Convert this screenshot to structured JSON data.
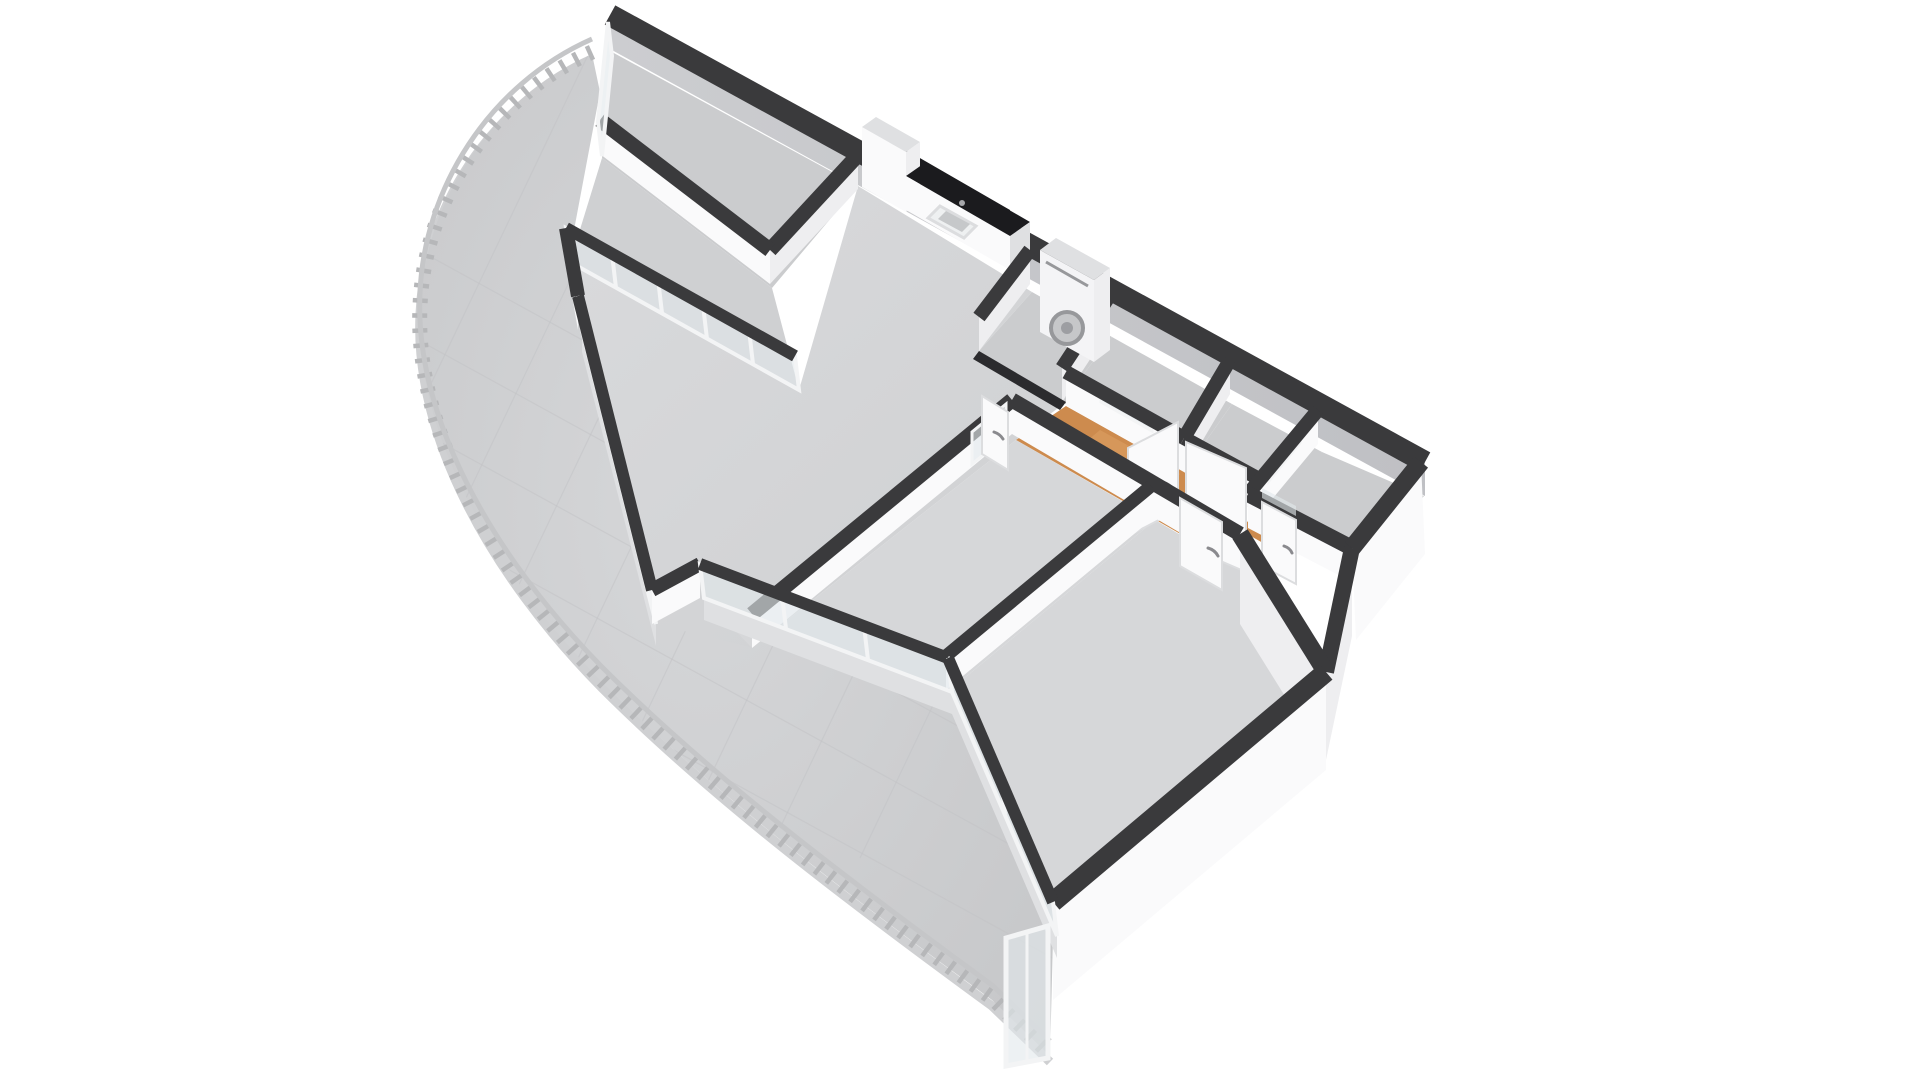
{
  "scene": {
    "kind": "3d-floorplan-axonometric-render",
    "background": "#ffffff",
    "colors": {
      "wall_cap": "#3a3a3c",
      "face_white": "#fafafb",
      "face_light": "#eeeef0",
      "face_gray": "#c7c8cb",
      "face_shade": "#dfe0e2",
      "floor_main": "#d6d7d9",
      "floor_dark": "#cbccce",
      "floor_balcony": "#cfd0d2",
      "wood": "#cd8b4e",
      "wood_light": "#dfa264",
      "counter": "#1b1b1e",
      "trim": "#2b2b2e",
      "railing_post": "#b6b7b9",
      "railing_rail": "#c5c6c8",
      "slab": "#cfd0d2",
      "glass": "#e2e8ec",
      "frame": "#f3f4f5",
      "appliance": "#f4f4f6",
      "appliance_detail": "#97989b"
    },
    "rooms": [
      {
        "id": "balcony",
        "floor": "gray-tile",
        "feature": "curved-edge-with-railing"
      },
      {
        "id": "top-room",
        "floor": "gray"
      },
      {
        "id": "living-room-with-open-kitchen",
        "floor": "gray"
      },
      {
        "id": "utility-closet",
        "floor": "gray",
        "feature": "stacked-washer-dryer"
      },
      {
        "id": "bathroom",
        "floor": "gray"
      },
      {
        "id": "toilet",
        "floor": "gray"
      },
      {
        "id": "entry-hallway",
        "floor": "orange-wood"
      },
      {
        "id": "storage-room-right",
        "floor": "gray",
        "feature": "wood-threshold"
      },
      {
        "id": "bedroom-left",
        "floor": "gray",
        "feature": "glazed-wall-to-balcony"
      },
      {
        "id": "bedroom-right",
        "floor": "gray"
      }
    ],
    "fixtures": [
      "kitchen-counter-dark-top-with-sink",
      "kitchen-tall-cabinet",
      "stacked-washer-dryer",
      "front-door-open-with-transom",
      "bathroom-door-open-with-transom",
      "interior-door-leaves-with-handles",
      "balcony-railing-posts",
      "floor-to-ceiling-glazing",
      "balcony-end-glass-door"
    ]
  }
}
